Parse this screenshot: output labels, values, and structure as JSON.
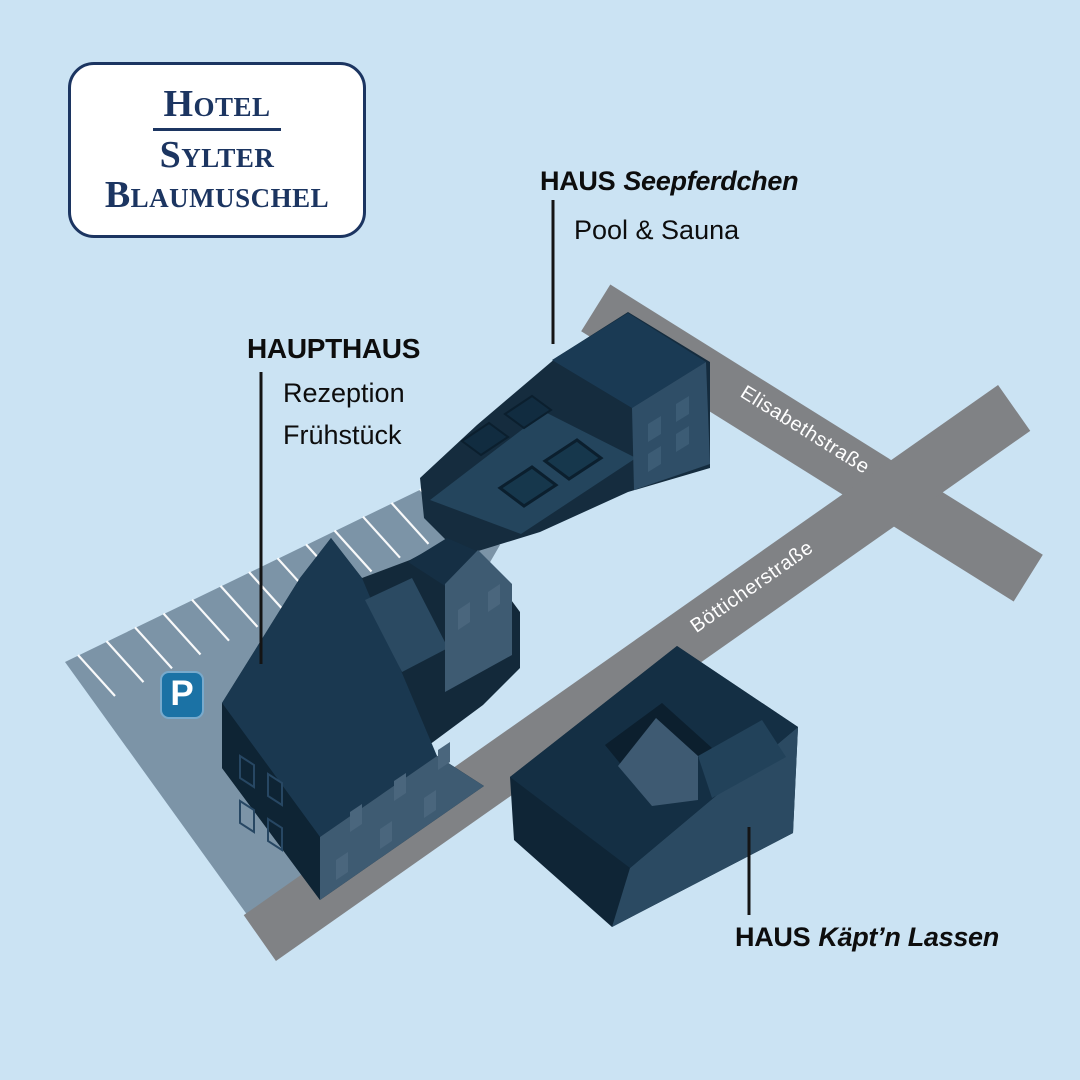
{
  "logo": {
    "line1": "Hotel",
    "line2": "Sylter",
    "line3": "Blaumuschel"
  },
  "labels": {
    "seepferdchen": {
      "prefix": "HAUS",
      "name": "Seepferdchen",
      "sub": "Pool & Sauna"
    },
    "haupthaus": {
      "title": "HAUPTHAUS",
      "sub1": "Rezeption",
      "sub2": "Frühstück"
    },
    "kaeptn": {
      "prefix": "HAUS",
      "name": "Käpt’n Lassen"
    }
  },
  "streets": {
    "elisabeth": "Elisabethstraße",
    "boetticher": "Bötticherstraße"
  },
  "parking": {
    "sign": "P"
  },
  "colors": {
    "background": "#cbe3f3",
    "road_gray": "#808285",
    "parking_lot": "#7c94a7",
    "building_dark_navy": "#13293a",
    "building_roof": "#1a3850",
    "building_wall_medium": "#2f4e67",
    "building_wall_light": "#3e5b72",
    "logo_navy": "#1c3561",
    "parking_sign_blue": "#1b72a5",
    "label_text": "#0d0d0d",
    "street_text": "#ffffff"
  }
}
